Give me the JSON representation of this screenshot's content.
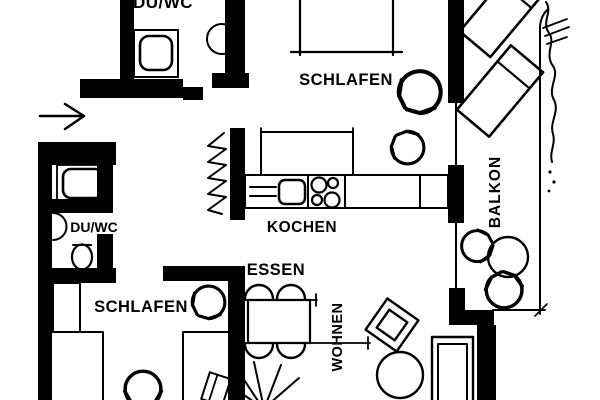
{
  "colors": {
    "background": "#ffffff",
    "ink": "#000000"
  },
  "rooms": {
    "bath_top": "DU/WC",
    "bedroom_top": "SCHLAFEN",
    "balcony": "BALKON",
    "kitchen": "KOCHEN",
    "bath_lower": "DU/WC",
    "bedroom_lower": "SCHLAFEN",
    "dining": "ESSEN",
    "living": "WOHNEN"
  },
  "depicted_objects": [
    "washing-machine",
    "washbasin",
    "shower",
    "toilet",
    "bed",
    "wardrobe",
    "kitchen-counter",
    "sink",
    "stove",
    "dining-table",
    "chairs",
    "plant",
    "armchair",
    "coffee-table",
    "sofa",
    "lounge-chairs",
    "balcony-table",
    "door-swing-arrows",
    "entrance-arrow",
    "balcony-railing"
  ]
}
